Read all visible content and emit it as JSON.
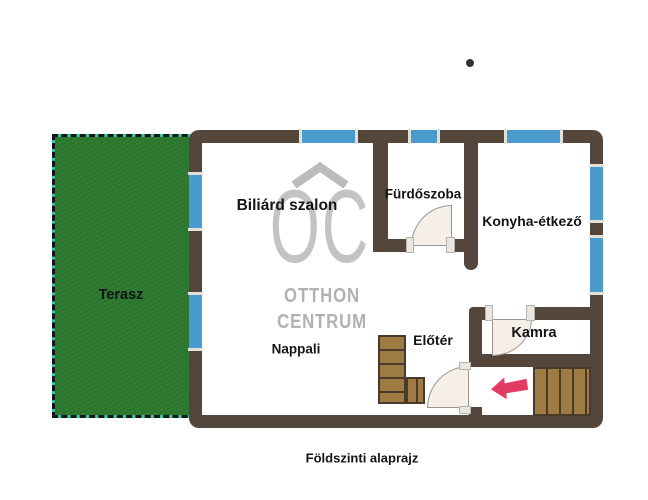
{
  "floorplan": {
    "caption": "Földszinti alaprajz",
    "rooms": {
      "billiard": "Biliárd szalon",
      "bathroom": "Fürdőszoba",
      "kitchen": "Konyha-étkező",
      "terrace": "Terasz",
      "living": "Nappali",
      "foyer": "Előtér",
      "pantry": "Kamra"
    }
  },
  "watermark": {
    "logo": "OC",
    "name_line1": "OTTHON",
    "name_line2": "CENTRUM"
  },
  "colors": {
    "wall": "#55463c",
    "window": "#4a9bcb",
    "terrace_fill": "#2c7a2f",
    "terrace_border": "#35c7a5",
    "door_fill": "#f6efe7",
    "stairs_fill": "#9d7b42",
    "stairs_line": "#4a3a2b",
    "arrow": "#e23b61",
    "watermark_gray": "#bcbab9",
    "label_text": "#141414"
  }
}
